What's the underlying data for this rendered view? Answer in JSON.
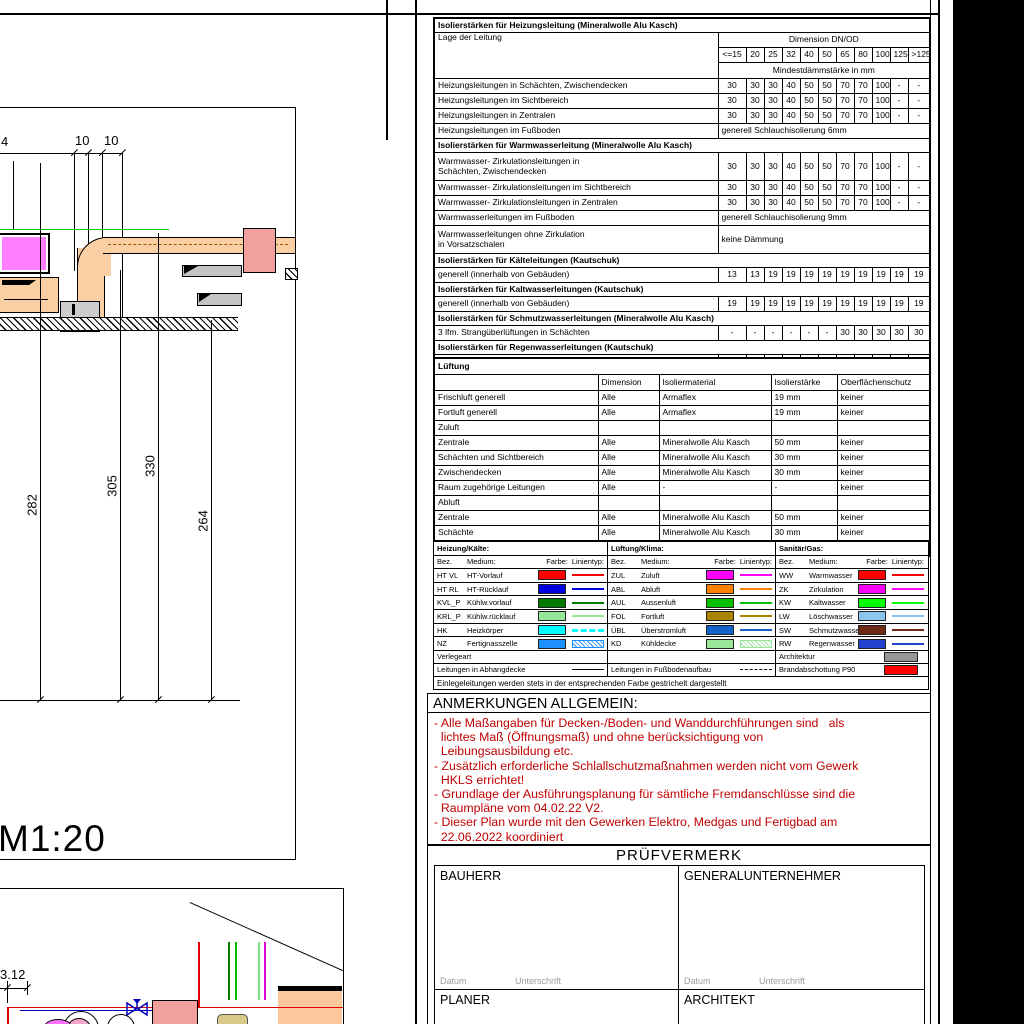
{
  "insulation_table": {
    "lage_header": "Lage der Leitung",
    "dim_header": "Dimension DN/OD",
    "min_header": "Mindestdämmstärke in mm",
    "dims": [
      "<=15",
      "20",
      "25",
      "32",
      "40",
      "50",
      "65",
      "80",
      "100",
      "125",
      ">125"
    ],
    "rows": [
      {
        "type": "title",
        "text": "Isolierstärken für Heizungsleitung (Mineralwolle Alu Kasch)"
      },
      {
        "type": "dimheader"
      },
      {
        "type": "data",
        "label": "Heizungsleitungen in Schächten, Zwischendecken",
        "values": [
          "30",
          "30",
          "30",
          "40",
          "50",
          "50",
          "70",
          "70",
          "100",
          "-",
          "-"
        ]
      },
      {
        "type": "data",
        "label": "Heizungsleitungen im Sichtbereich",
        "values": [
          "30",
          "30",
          "30",
          "40",
          "50",
          "50",
          "70",
          "70",
          "100",
          "-",
          "-"
        ]
      },
      {
        "type": "data",
        "label": "Heizungsleitungen in Zentralen",
        "values": [
          "30",
          "30",
          "30",
          "40",
          "50",
          "50",
          "70",
          "70",
          "100",
          "-",
          "-"
        ]
      },
      {
        "type": "merge",
        "label": "Heizungsleitungen im Fußboden",
        "text": "generell Schlauchisolierung 6mm"
      },
      {
        "type": "title",
        "text": "Isolierstärken für Warmwasserleitung (Mineralwolle Alu Kasch)"
      },
      {
        "type": "data",
        "tall": true,
        "label": "Warmwasser- Zirkulationsleitungen in\nSchächten, Zwischendecken",
        "values": [
          "30",
          "30",
          "30",
          "40",
          "50",
          "50",
          "70",
          "70",
          "100",
          "-",
          "-"
        ]
      },
      {
        "type": "data",
        "label": "Warmwasser- Zirkulationsleitungen im Sichtbereich",
        "values": [
          "30",
          "30",
          "30",
          "40",
          "50",
          "50",
          "70",
          "70",
          "100",
          "-",
          "-"
        ]
      },
      {
        "type": "data",
        "label": "Warmwasser- Zirkulationsleitungen in Zentralen",
        "values": [
          "30",
          "30",
          "30",
          "40",
          "50",
          "50",
          "70",
          "70",
          "100",
          "-",
          "-"
        ]
      },
      {
        "type": "merge",
        "label": "Warmwasserleitungen im Fußboden",
        "text": "generell Schlauchisolierung 9mm"
      },
      {
        "type": "merge",
        "tall": true,
        "label": "Warmwasserleitungen ohne Zirkulation\nin Vorsatzschalen",
        "text": "keine Dämmung"
      },
      {
        "type": "title",
        "text": "Isolierstärken für Kälteleitungen (Kautschuk)"
      },
      {
        "type": "data",
        "label": "generell (innerhalb von Gebäuden)",
        "values": [
          "13",
          "13",
          "19",
          "19",
          "19",
          "19",
          "19",
          "19",
          "19",
          "19",
          "19"
        ]
      },
      {
        "type": "title",
        "text": "Isolierstärken für Kaltwasserleitungen (Kautschuk)"
      },
      {
        "type": "data",
        "label": "generell (innerhalb von Gebäuden)",
        "values": [
          "19",
          "19",
          "19",
          "19",
          "19",
          "19",
          "19",
          "19",
          "19",
          "19",
          "19"
        ]
      },
      {
        "type": "title",
        "text": "Isolierstärken für Schmutzwasserleitungen (Mineralwolle Alu Kasch)"
      },
      {
        "type": "data",
        "label": "3 lfm. Strangüberlüftungen in Schächten",
        "values": [
          "-",
          "-",
          "-",
          "-",
          "-",
          "-",
          "30",
          "30",
          "30",
          "30",
          "30"
        ]
      },
      {
        "type": "title",
        "text": "Isolierstärken für Regenwasserleitungen (Kautschuk)"
      },
      {
        "type": "data",
        "label": "generell (innerhalb von Gebäuden)",
        "values": [
          "19",
          "19",
          "19",
          "19",
          "19",
          "19",
          "19",
          "19",
          "19",
          "19",
          "19"
        ]
      }
    ]
  },
  "lueftung_table": {
    "title": "Lüftung",
    "headers": [
      "",
      "Dimension",
      "Isoliermaterial",
      "Isolierstärke",
      "Oberflächenschutz"
    ],
    "rows": [
      {
        "cells": [
          "Frischluft generell",
          "Alle",
          "Armaflex",
          "19 mm",
          "keiner"
        ]
      },
      {
        "cells": [
          "Fortluft generell",
          "Alle",
          "Armaflex",
          "19 mm",
          "keiner"
        ]
      },
      {
        "cells": [
          "Zuluft",
          "",
          "",
          "",
          ""
        ]
      },
      {
        "cells": [
          "Zentrale",
          "Alle",
          "Mineralwolle Alu Kasch",
          "50 mm",
          "keiner"
        ]
      },
      {
        "cells": [
          "Schächten und Sichtbereich",
          "Alle",
          "Mineralwolle Alu Kasch",
          "30 mm",
          "keiner"
        ]
      },
      {
        "cells": [
          "Zwischendecken",
          "Alle",
          "Mineralwolle Alu Kasch",
          "30 mm",
          "keiner"
        ]
      },
      {
        "cells": [
          "Raum zugehörige Leitungen",
          "Alle",
          "-",
          "-",
          "keiner"
        ]
      },
      {
        "cells": [
          "Abluft",
          "",
          "",
          "",
          ""
        ]
      },
      {
        "cells": [
          "Zentrale",
          "Alle",
          "Mineralwolle Alu Kasch",
          "50 mm",
          "keiner"
        ]
      },
      {
        "cells": [
          "Schächte",
          "Alle",
          "Mineralwolle Alu Kasch",
          "30 mm",
          "keiner"
        ]
      },
      {
        "cells": [
          "Alle weiteren Leitungen",
          "Alle",
          "-",
          "-",
          "keiner"
        ]
      }
    ]
  },
  "legend": {
    "headers": {
      "bez": "Bez.",
      "medium": "Medium:",
      "farbe": "Farbe:",
      "linientyp": "Linientyp:"
    },
    "groups": [
      {
        "title": "Heizung/Kälte:",
        "items": [
          {
            "bez": "HT VL",
            "medium": "HT-Vorlauf",
            "color": "#ff0000",
            "line": "solid"
          },
          {
            "bez": "HT RL",
            "medium": "HT-Rücklauf",
            "color": "#0000e0",
            "line": "solid"
          },
          {
            "bez": "KVL_P",
            "medium": "Kühlw.vorlauf",
            "color": "#007a00",
            "line": "solid"
          },
          {
            "bez": "KRL_P",
            "medium": "Kühlw.rücklauf",
            "color": "#98e698",
            "line": "solid"
          },
          {
            "bez": "HK",
            "medium": "Heizkörper",
            "color": "#00ffff",
            "line": "dashed"
          },
          {
            "bez": "NZ",
            "medium": "Fertignasszelle",
            "color": "#1e90ff",
            "line": "hatch"
          }
        ]
      },
      {
        "title": "Lüftung/Klima:",
        "items": [
          {
            "bez": "ZUL",
            "medium": "Zuluft",
            "color": "#ff00ff",
            "line": "solid"
          },
          {
            "bez": "ABL",
            "medium": "Abluft",
            "color": "#ff8000",
            "line": "solid"
          },
          {
            "bez": "AUL",
            "medium": "Aussenluft",
            "color": "#00c000",
            "line": "solid"
          },
          {
            "bez": "FOL",
            "medium": "Fortluft",
            "color": "#a88400",
            "line": "solid"
          },
          {
            "bez": "ÜBL",
            "medium": "Überstromluft",
            "color": "#1661c6",
            "line": "solid"
          },
          {
            "bez": "KD",
            "medium": "Kühldecke",
            "color": "#98e698",
            "line": "hatch"
          }
        ]
      },
      {
        "title": "Sanitär/Gas:",
        "items": [
          {
            "bez": "WW",
            "medium": "Warmwasser",
            "color": "#ff0000",
            "line": "solid"
          },
          {
            "bez": "ZK",
            "medium": "Zirkulation",
            "color": "#ff00ff",
            "line": "solid"
          },
          {
            "bez": "KW",
            "medium": "Kaltwasser",
            "color": "#00ff00",
            "line": "solid"
          },
          {
            "bez": "LW",
            "medium": "Löschwasser",
            "color": "#8cc6f0",
            "line": "solid"
          },
          {
            "bez": "SW",
            "medium": "Schmutzwasser",
            "color": "#6e2a16",
            "line": "solid"
          },
          {
            "bez": "RW",
            "medium": "Regenwasser",
            "color": "#2244cc",
            "line": "solid"
          }
        ]
      }
    ],
    "verlegeart_label": "Verlegeart",
    "architektur_label": "Architektur",
    "architektur_color": "#969696",
    "abhangdecke_label": "Leitungen in Abhangdecke",
    "fussboden_label": "Leitungen in Fußbodenaufbau",
    "brandabschottung_label": "Brandabschottung P90",
    "brandabschottung_color": "#ff0000",
    "note": "Einlegeleitungen werden stets in der entsprechenden Farbe gestrichelt dargestellt"
  },
  "anmerkungen": {
    "title": "ANMERKUNGEN ALLGEMEIN:",
    "lines": [
      "- Alle Maßangaben für Decken-/Boden- und Wanddurchführungen sind   als",
      "  lichtes Maß (Öffnungsmaß) und ohne berücksichtigung von",
      "  Leibungsausbildung etc.",
      "- Zusätzlich erforderliche Schlallschutzmaßnahmen werden nicht vom Gewerk",
      "  HKLS errichtet!",
      "- Grundlage der Ausführungsplanung für sämtliche Fremdanschlüsse sind die",
      "  Raumpläne vom 04.02.22 V2.",
      "- Dieser Plan wurde mit den Gewerken Elektro, Medgas und Fertigbad am",
      "  22.06.2022 koordiniert"
    ]
  },
  "pruefvermerk": {
    "title": "PRÜFVERMERK",
    "boxes": [
      [
        "BAUHERR",
        "GENERALUNTERNEHMER"
      ],
      [
        "PLANER",
        "ARCHITEKT"
      ]
    ],
    "datum_label": "Datum",
    "unterschrift_label": "Unterschrift"
  },
  "drawing1": {
    "dim_top_left": "4",
    "dim_top_1": "10",
    "dim_top_2": "10",
    "dim_v_1": "282",
    "dim_v_2": "305",
    "dim_v_3": "330",
    "dim_v_4": "264",
    "scale_label": "M1:20"
  },
  "drawing2": {
    "dim_label": "3.12"
  }
}
